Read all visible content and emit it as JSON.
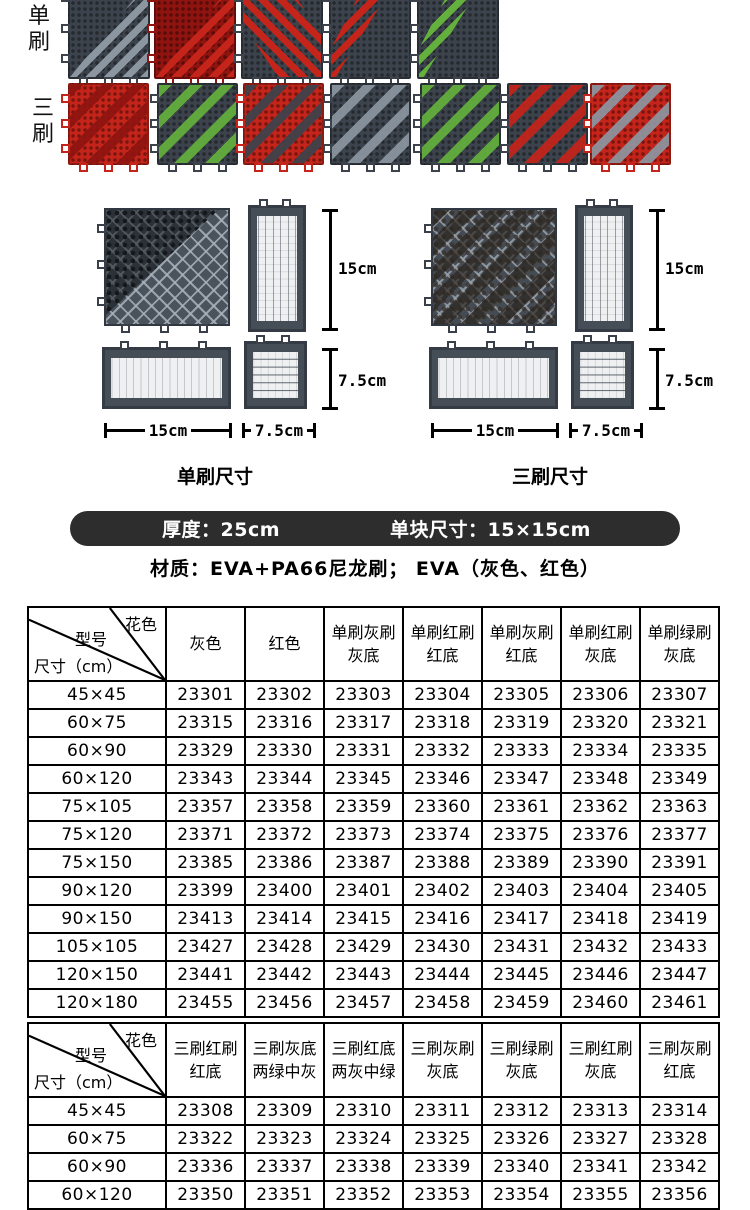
{
  "colors": {
    "page_bg": "#ffffff",
    "tile_red": "#c5241a",
    "tile_red_dark": "#8f1410",
    "tile_gray": "#3c434c",
    "tile_gray_light": "#8b96a1",
    "brush_green": "#63b13c",
    "diagram_tile": "#49515b",
    "hole_color": "#eef0f1",
    "banner_bg": "#2e2d2d",
    "banner_text": "#ffffff",
    "table_border": "#000000"
  },
  "top_section": {
    "row1_label": "单刷",
    "row2_label": "三刷",
    "row1_tiles": [
      {
        "name": "gray-brush-gray-base",
        "base": "tile_gray",
        "brush": "tile_gray_light",
        "pattern": "half"
      },
      {
        "name": "red-brush-red-base",
        "base": "tile_red_dark",
        "brush": "tile_red",
        "pattern": "half"
      },
      {
        "name": "red-brush-gray-corner",
        "base": "tile_gray",
        "brush": "tile_red",
        "pattern": "bigband"
      },
      {
        "name": "red-brush-gray-base",
        "base": "tile_gray",
        "brush": "tile_red",
        "pattern": "band"
      },
      {
        "name": "green-brush-gray-base",
        "base": "tile_gray",
        "brush": "brush_green",
        "pattern": "band"
      }
    ],
    "row2_tiles": [
      {
        "name": "red-brush-red-base",
        "base": "tile_red",
        "brush": "tile_red_dark",
        "pattern": "full"
      },
      {
        "name": "green-brush-gray-base",
        "base": "tile_gray",
        "brush": "brush_green",
        "pattern": "full"
      },
      {
        "name": "gray-brush-red-base",
        "base": "tile_red",
        "brush": "tile_gray",
        "pattern": "full"
      },
      {
        "name": "gray-brush-gray-base",
        "base": "tile_gray",
        "brush": "tile_gray_light",
        "pattern": "full"
      },
      {
        "name": "green-brush-gray-base-2",
        "base": "tile_gray",
        "brush": "brush_green",
        "pattern": "full"
      },
      {
        "name": "red-brush-gray-base",
        "base": "tile_gray",
        "brush": "tile_red",
        "pattern": "full"
      },
      {
        "name": "gray-brush-red-base-2",
        "base": "tile_red",
        "brush": "tile_gray_light",
        "pattern": "full"
      }
    ]
  },
  "diagrams": [
    {
      "caption": "单刷尺寸",
      "height_label": "15cm",
      "height_small_label": "7.5cm",
      "width_label": "15cm",
      "width_small_label": "7.5cm"
    },
    {
      "caption": "三刷尺寸",
      "height_label": "15cm",
      "height_small_label": "7.5cm",
      "width_label": "15cm",
      "width_small_label": "7.5cm"
    }
  ],
  "banner": {
    "thickness": "厚度：25cm",
    "tile_size": "单块尺寸：15×15cm"
  },
  "material_line": "材质：EVA+PA66尼龙刷；  EVA（灰色、红色）",
  "table_single": {
    "corner": {
      "top_right": "花色",
      "middle": "型号",
      "bottom_left": "尺寸（cm）"
    },
    "columns": [
      [
        "灰色"
      ],
      [
        "红色"
      ],
      [
        "单刷灰刷",
        "灰底"
      ],
      [
        "单刷红刷",
        "红底"
      ],
      [
        "单刷灰刷",
        "红底"
      ],
      [
        "单刷红刷",
        "灰底"
      ],
      [
        "单刷绿刷",
        "灰底"
      ]
    ],
    "rows": [
      {
        "size": "45×45",
        "codes": [
          "23301",
          "23302",
          "23303",
          "23304",
          "23305",
          "23306",
          "23307"
        ]
      },
      {
        "size": "60×75",
        "codes": [
          "23315",
          "23316",
          "23317",
          "23318",
          "23319",
          "23320",
          "23321"
        ]
      },
      {
        "size": "60×90",
        "codes": [
          "23329",
          "23330",
          "23331",
          "23332",
          "23333",
          "23334",
          "23335"
        ]
      },
      {
        "size": "60×120",
        "codes": [
          "23343",
          "23344",
          "23345",
          "23346",
          "23347",
          "23348",
          "23349"
        ]
      },
      {
        "size": "75×105",
        "codes": [
          "23357",
          "23358",
          "23359",
          "23360",
          "23361",
          "23362",
          "23363"
        ]
      },
      {
        "size": "75×120",
        "codes": [
          "23371",
          "23372",
          "23373",
          "23374",
          "23375",
          "23376",
          "23377"
        ]
      },
      {
        "size": "75×150",
        "codes": [
          "23385",
          "23386",
          "23387",
          "23388",
          "23389",
          "23390",
          "23391"
        ]
      },
      {
        "size": "90×120",
        "codes": [
          "23399",
          "23400",
          "23401",
          "23402",
          "23403",
          "23404",
          "23405"
        ]
      },
      {
        "size": "90×150",
        "codes": [
          "23413",
          "23414",
          "23415",
          "23416",
          "23417",
          "23418",
          "23419"
        ]
      },
      {
        "size": "105×105",
        "codes": [
          "23427",
          "23428",
          "23429",
          "23430",
          "23431",
          "23432",
          "23433"
        ]
      },
      {
        "size": "120×150",
        "codes": [
          "23441",
          "23442",
          "23443",
          "23444",
          "23445",
          "23446",
          "23447"
        ]
      },
      {
        "size": "120×180",
        "codes": [
          "23455",
          "23456",
          "23457",
          "23458",
          "23459",
          "23460",
          "23461"
        ]
      }
    ]
  },
  "table_triple": {
    "corner": {
      "top_right": "花色",
      "middle": "型号",
      "bottom_left": "尺寸（cm）"
    },
    "columns": [
      [
        "三刷红刷",
        "红底"
      ],
      [
        "三刷灰底",
        "两绿中灰"
      ],
      [
        "三刷红底",
        "两灰中绿"
      ],
      [
        "三刷灰刷",
        "灰底"
      ],
      [
        "三刷绿刷",
        "灰底"
      ],
      [
        "三刷红刷",
        "灰底"
      ],
      [
        "三刷灰刷",
        "红底"
      ]
    ],
    "rows": [
      {
        "size": "45×45",
        "codes": [
          "23308",
          "23309",
          "23310",
          "23311",
          "23312",
          "23313",
          "23314"
        ]
      },
      {
        "size": "60×75",
        "codes": [
          "23322",
          "23323",
          "23324",
          "23325",
          "23326",
          "23327",
          "23328"
        ]
      },
      {
        "size": "60×90",
        "codes": [
          "23336",
          "23337",
          "23338",
          "23339",
          "23340",
          "23341",
          "23342"
        ]
      },
      {
        "size": "60×120",
        "codes": [
          "23350",
          "23351",
          "23352",
          "23353",
          "23354",
          "23355",
          "23356"
        ]
      }
    ]
  }
}
